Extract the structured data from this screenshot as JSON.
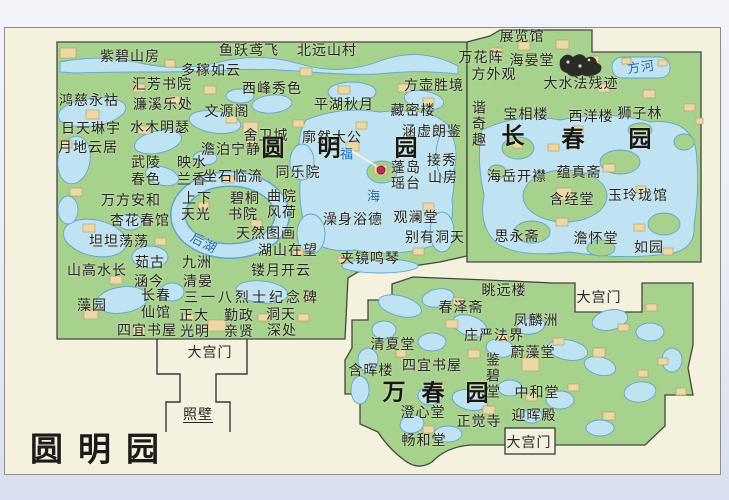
{
  "map_title": "圆明园",
  "colors": {
    "land": "#a7d28d",
    "water": "#bfe3f2",
    "water_outline": "#5fa6cc",
    "building": "#ead9a6",
    "map_background": "#f4f1df",
    "outer_background": "#e9ecf6",
    "label_text": "#262624",
    "water_label_text": "#1668b8",
    "scenic_dot": "#c12b4e",
    "garden_outline": "#454540"
  },
  "gardens": [
    "圆明园",
    "长春园",
    "万春园"
  ],
  "icons": [
    {
      "name": "ruins-icon",
      "x": 575,
      "y": 62
    },
    {
      "name": "scenic-spot-dot",
      "x": 381,
      "y": 170
    }
  ],
  "labels": [
    {
      "t": "紫碧山房",
      "x": 130,
      "y": 56
    },
    {
      "t": "鱼跃鸢飞",
      "x": 249,
      "y": 50
    },
    {
      "t": "北远山村",
      "x": 327,
      "y": 50
    },
    {
      "t": "多稼如云",
      "x": 211,
      "y": 70
    },
    {
      "t": "汇芳书院",
      "x": 162,
      "y": 84
    },
    {
      "t": "西峰秀色",
      "x": 272,
      "y": 88
    },
    {
      "t": "方壶胜境",
      "x": 434,
      "y": 85
    },
    {
      "t": "鸿慈永祜",
      "x": 89,
      "y": 100
    },
    {
      "t": "濂溪乐处",
      "x": 163,
      "y": 104
    },
    {
      "t": "文源阁",
      "x": 227,
      "y": 111
    },
    {
      "t": "平湖秋月",
      "x": 344,
      "y": 104
    },
    {
      "t": "藏密楼",
      "x": 413,
      "y": 110
    },
    {
      "t": "日天琳宇",
      "x": 91,
      "y": 128
    },
    {
      "t": "水木明瑟",
      "x": 160,
      "y": 127
    },
    {
      "t": "舍卫城",
      "x": 266,
      "y": 135
    },
    {
      "t": "廓然大公",
      "x": 332,
      "y": 137
    },
    {
      "t": "涵虚朗鉴",
      "x": 432,
      "y": 131
    },
    {
      "t": "月地云居",
      "x": 88,
      "y": 147
    },
    {
      "t": "澹泊宁静",
      "x": 231,
      "y": 149
    },
    {
      "t": "圆",
      "x": 273,
      "y": 148,
      "k": "b"
    },
    {
      "t": "明",
      "x": 329,
      "y": 148,
      "k": "b"
    },
    {
      "t": "园",
      "x": 406,
      "y": 148,
      "k": "b"
    },
    {
      "t": "福",
      "x": 347,
      "y": 154,
      "k": "w"
    },
    {
      "t": "海",
      "x": 374,
      "y": 196,
      "k": "w"
    },
    {
      "t": "武陵",
      "x": 146,
      "y": 162
    },
    {
      "t": "春色",
      "x": 146,
      "y": 179
    },
    {
      "t": "映水",
      "x": 192,
      "y": 162
    },
    {
      "t": "兰香",
      "x": 192,
      "y": 179
    },
    {
      "t": "坐石临流",
      "x": 233,
      "y": 176
    },
    {
      "t": "同乐院",
      "x": 298,
      "y": 172
    },
    {
      "t": "万方安和",
      "x": 131,
      "y": 200
    },
    {
      "t": "上下",
      "x": 197,
      "y": 198
    },
    {
      "t": "天光",
      "x": 196,
      "y": 214
    },
    {
      "t": "碧桐",
      "x": 245,
      "y": 198
    },
    {
      "t": "书院",
      "x": 243,
      "y": 214
    },
    {
      "t": "曲院",
      "x": 282,
      "y": 196
    },
    {
      "t": "风荷",
      "x": 282,
      "y": 212
    },
    {
      "t": "杏花春馆",
      "x": 140,
      "y": 220
    },
    {
      "t": "坦坦荡荡",
      "x": 119,
      "y": 241
    },
    {
      "t": "后湖",
      "x": 204,
      "y": 243,
      "k": "w",
      "r": 28
    },
    {
      "t": "天然图画",
      "x": 266,
      "y": 233
    },
    {
      "t": "湖山在望",
      "x": 288,
      "y": 250
    },
    {
      "t": "澡身浴德",
      "x": 353,
      "y": 219
    },
    {
      "t": "观澜堂",
      "x": 416,
      "y": 217
    },
    {
      "t": "别有洞天",
      "x": 435,
      "y": 237
    },
    {
      "t": "夹镜鸣琴",
      "x": 370,
      "y": 258
    },
    {
      "t": "蓬岛",
      "x": 406,
      "y": 167
    },
    {
      "t": "瑶台",
      "x": 406,
      "y": 183
    },
    {
      "t": "接秀",
      "x": 442,
      "y": 160
    },
    {
      "t": "山房",
      "x": 443,
      "y": 177
    },
    {
      "t": "山高水长",
      "x": 97,
      "y": 270
    },
    {
      "t": "茹古",
      "x": 150,
      "y": 262
    },
    {
      "t": "涵今",
      "x": 149,
      "y": 281
    },
    {
      "t": "九洲",
      "x": 197,
      "y": 262
    },
    {
      "t": "清晏",
      "x": 198,
      "y": 281
    },
    {
      "t": "镂月开云",
      "x": 281,
      "y": 270
    },
    {
      "t": "藻园",
      "x": 92,
      "y": 305
    },
    {
      "t": "长春",
      "x": 156,
      "y": 295
    },
    {
      "t": "仙馆",
      "x": 156,
      "y": 312
    },
    {
      "t": "三一八烈士纪念碑",
      "x": 252,
      "y": 297,
      "ls": 3
    },
    {
      "t": "正大",
      "x": 194,
      "y": 315
    },
    {
      "t": "光明",
      "x": 195,
      "y": 331
    },
    {
      "t": "勤政",
      "x": 239,
      "y": 315
    },
    {
      "t": "亲贤",
      "x": 239,
      "y": 331
    },
    {
      "t": "洞天",
      "x": 281,
      "y": 314
    },
    {
      "t": "深处",
      "x": 282,
      "y": 330
    },
    {
      "t": "四宜书屋",
      "x": 147,
      "y": 330
    },
    {
      "t": "大宫门",
      "x": 210,
      "y": 352
    },
    {
      "t": "照壁",
      "x": 198,
      "y": 414,
      "u": 1
    },
    {
      "t": "展览馆",
      "x": 522,
      "y": 36
    },
    {
      "t": "万花阵",
      "x": 481,
      "y": 57
    },
    {
      "t": "海晏堂",
      "x": 532,
      "y": 60
    },
    {
      "t": "方外观",
      "x": 494,
      "y": 74
    },
    {
      "t": "大水法残迹",
      "x": 581,
      "y": 83
    },
    {
      "t": "方河",
      "x": 641,
      "y": 67,
      "k": "w",
      "r": -8
    },
    {
      "t": "谐奇趣",
      "x": 479,
      "y": 124,
      "k": "v"
    },
    {
      "t": "宝相楼",
      "x": 526,
      "y": 114
    },
    {
      "t": "西洋楼",
      "x": 591,
      "y": 116
    },
    {
      "t": "狮子林",
      "x": 640,
      "y": 113
    },
    {
      "t": "长",
      "x": 513,
      "y": 136,
      "k": "b"
    },
    {
      "t": "春",
      "x": 573,
      "y": 139,
      "k": "b"
    },
    {
      "t": "园",
      "x": 640,
      "y": 139,
      "k": "b"
    },
    {
      "t": "海岳开襟",
      "x": 517,
      "y": 176
    },
    {
      "t": "蕴真斋",
      "x": 579,
      "y": 172
    },
    {
      "t": "含经堂",
      "x": 572,
      "y": 199
    },
    {
      "t": "玉玲珑馆",
      "x": 638,
      "y": 195
    },
    {
      "t": "思永斋",
      "x": 517,
      "y": 236
    },
    {
      "t": "澹怀堂",
      "x": 596,
      "y": 238
    },
    {
      "t": "如园",
      "x": 649,
      "y": 247
    },
    {
      "t": "大宫门",
      "x": 599,
      "y": 297
    },
    {
      "t": "眺远楼",
      "x": 504,
      "y": 290
    },
    {
      "t": "春泽斋",
      "x": 461,
      "y": 307
    },
    {
      "t": "凤麟洲",
      "x": 536,
      "y": 320
    },
    {
      "t": "庄严法界",
      "x": 494,
      "y": 335
    },
    {
      "t": "蔚藻堂",
      "x": 533,
      "y": 352
    },
    {
      "t": "清夏堂",
      "x": 393,
      "y": 344
    },
    {
      "t": "含晖楼",
      "x": 371,
      "y": 370
    },
    {
      "t": "四宜书屋",
      "x": 432,
      "y": 365
    },
    {
      "t": "鉴碧堂",
      "x": 493,
      "y": 376,
      "k": "v"
    },
    {
      "t": "万",
      "x": 394,
      "y": 392,
      "k": "b"
    },
    {
      "t": "春",
      "x": 433,
      "y": 393,
      "k": "b"
    },
    {
      "t": "园",
      "x": 477,
      "y": 393,
      "k": "b"
    },
    {
      "t": "中和堂",
      "x": 537,
      "y": 392
    },
    {
      "t": "澄心堂",
      "x": 423,
      "y": 412
    },
    {
      "t": "正觉寺",
      "x": 479,
      "y": 421
    },
    {
      "t": "迎晖殿",
      "x": 534,
      "y": 415
    },
    {
      "t": "畅和堂",
      "x": 424,
      "y": 440
    },
    {
      "t": "大宫门",
      "x": 529,
      "y": 442
    },
    {
      "t": "圆明园",
      "x": 102,
      "y": 449,
      "k": "t"
    }
  ]
}
